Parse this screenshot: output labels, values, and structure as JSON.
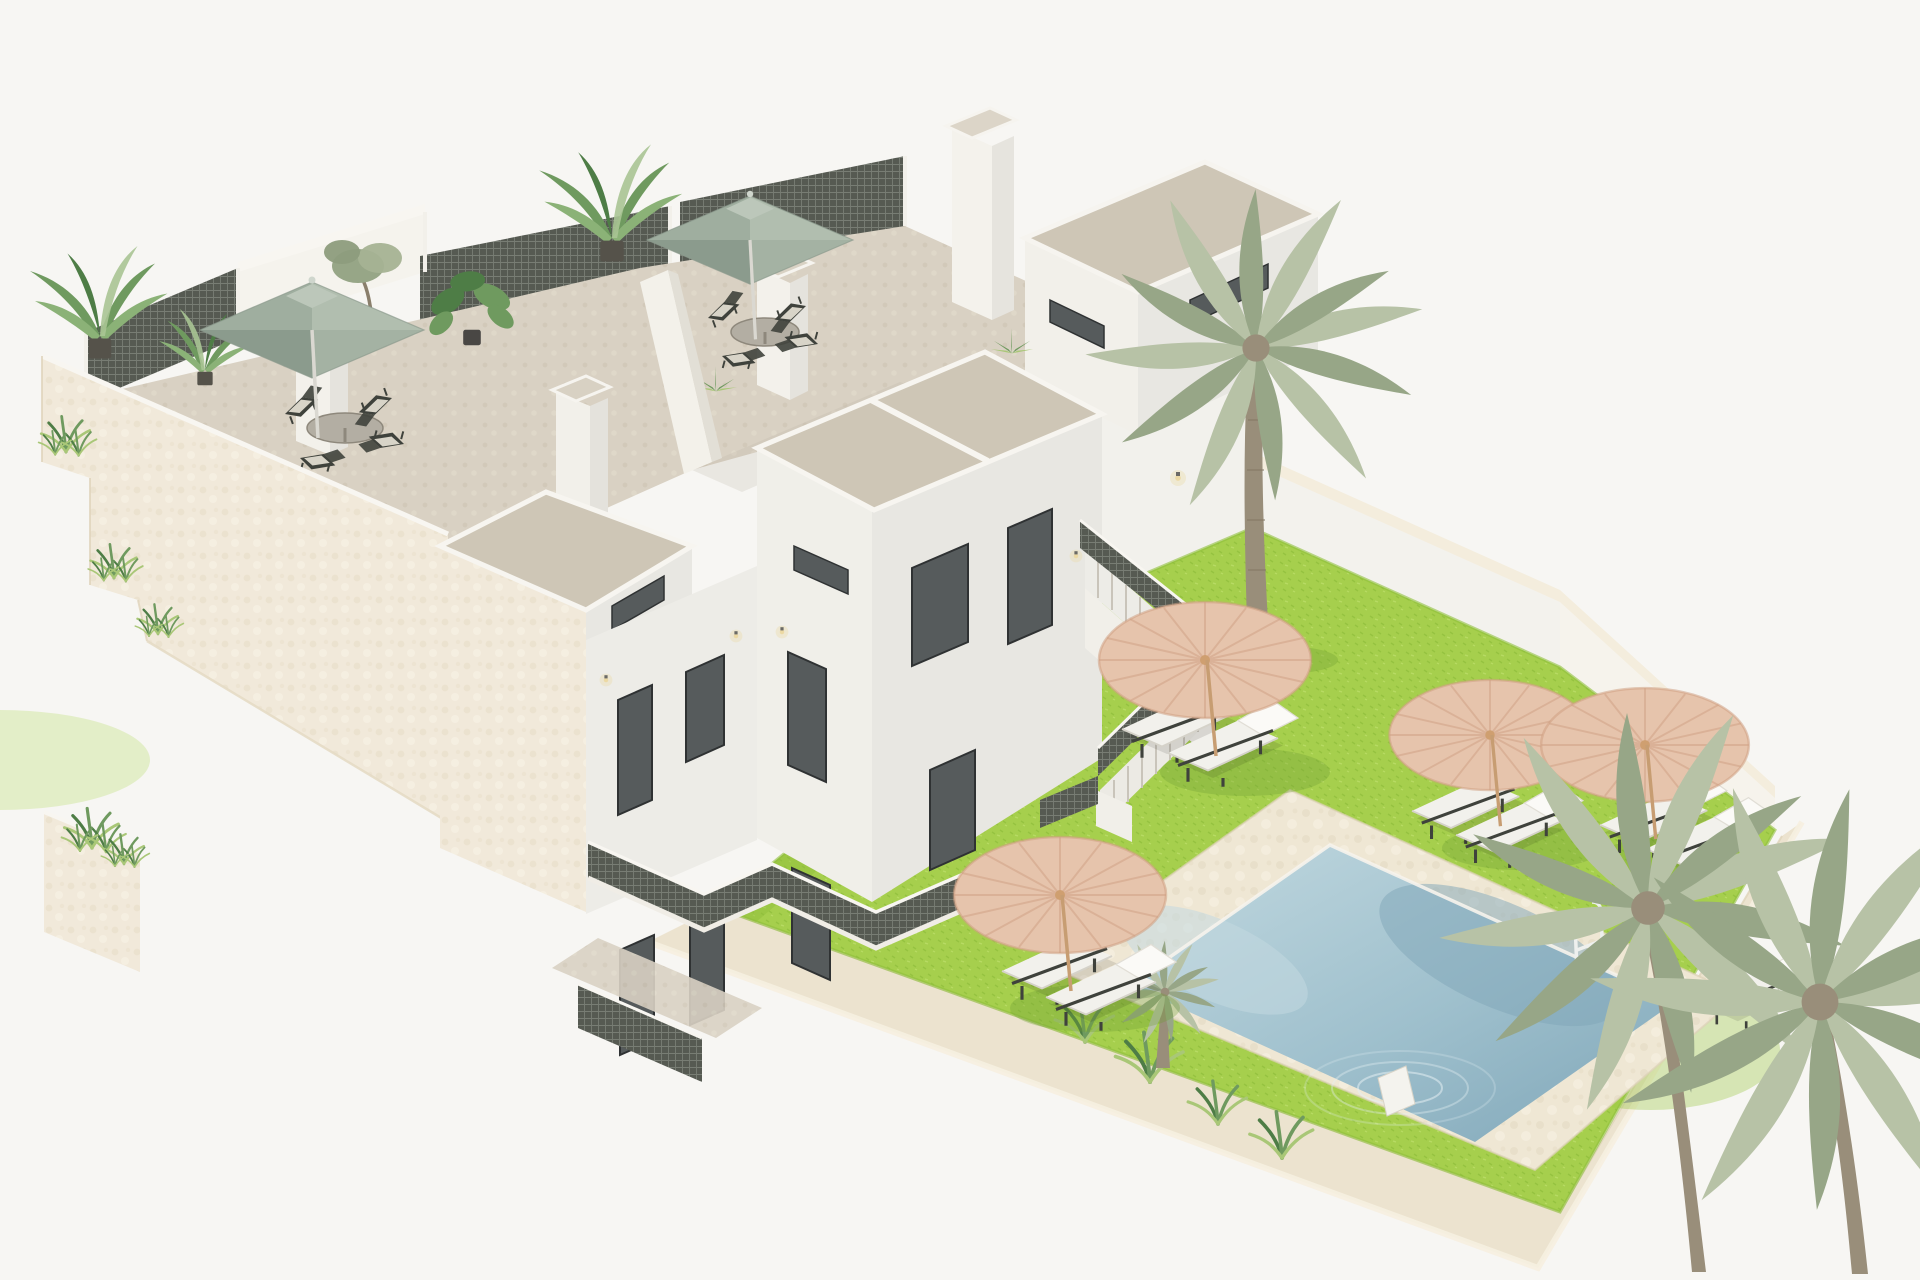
{
  "canvas": {
    "width": 1920,
    "height": 1280
  },
  "scene": {
    "type": "3d-architectural-render",
    "view": "aerial isometric",
    "description": "3D render of a modern white Mediterranean apartment building with rooftop terraces, sage parasols, plants, lattice screens, an exterior staircase, and a walled garden with bright green lawn, travertine pool deck, swimming pool with ladder, thatch umbrellas, white sun loungers and palm trees.",
    "background": "plain white"
  },
  "colors": {
    "bg": "#f7f6f3",
    "white-sun": "#f3f2ed",
    "white-shade": "#e8e7e2",
    "white-dark": "#dddbd6",
    "facade": "#f1e9da",
    "facade-shade": "#e4d9c2",
    "band": "#ece3cf",
    "band-light": "#f4eddd",
    "roof": "#cec6b6",
    "tfloor": "#d9d1c3",
    "cap": "#f8f6f1",
    "lattice": "#565a52",
    "sage-l": "#9fae9f",
    "sage-r": "#b1beaf",
    "sage-dl": "#8b9b8d",
    "sage-dr": "#a4b2a3",
    "sage-v": "#bcc7ba",
    "thatch": "#e6c4ac",
    "thatch-dark": "#cfa084",
    "lawn": "#a6cf4d",
    "lawn-shade": "#8ebd3a",
    "deck": "#efe7d4",
    "pool-light": "#c2d9e0",
    "pool-mid": "#9fc0cd",
    "pool-deep": "#7fa6b8",
    "palm-frond": "#97a687",
    "palm-frond-light": "#b7c2a6",
    "palm-trunk": "#998e7a",
    "plant": "#6f9a5f",
    "plant-dark": "#4e7d46",
    "furn": "#f2f1ec",
    "furn-frame": "#3f423c",
    "glass": "#565b5c",
    "frame-dark": "#2f3233",
    "lamp": "#ecd9a4"
  },
  "inventory": {
    "building": {
      "label": "white apartment block with two stair towers and cream textured street facade",
      "rooftop_terraces": 2,
      "sage_parasols": 2,
      "rooftop_dining_sets": 2,
      "chairs_per_set": 4,
      "lattice_screens": 3,
      "chimney_pillars": 3,
      "tower_roof_caps": 3,
      "wall_lamps": 7,
      "balcony_railings": "dark metal mesh, zigzag across courtyard",
      "exterior_staircase_flights": 2,
      "facade_planter_ledges": 4
    },
    "garden": {
      "label": "walled garden with lawn, pool and sunbathing area",
      "lawn_color": "bright yellow-green",
      "thatch_umbrellas": 4,
      "sun_loungers": 9,
      "pool": {
        "shape": "rectangular, rotated in isometric view",
        "ladder": 1,
        "white_step": 1,
        "ripples": true,
        "edge": "travertine deck"
      },
      "palm_trees_large": 3,
      "palm_trees_small": 1,
      "grass_tufts_poolside": 4,
      "perimeter_wall": "cream stone band on south and east sides"
    }
  }
}
